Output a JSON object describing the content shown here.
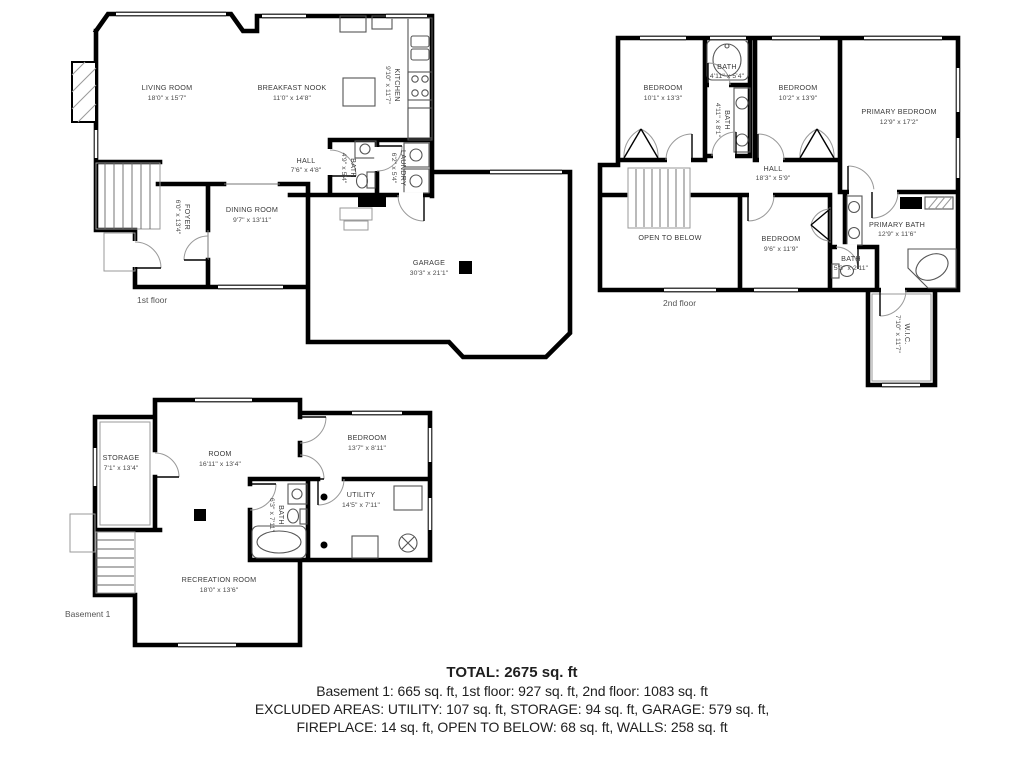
{
  "floors": {
    "first": {
      "label": "1st floor",
      "rooms": {
        "living": {
          "name": "LIVING ROOM",
          "dims": "18'0\" x 15'7\""
        },
        "nook": {
          "name": "BREAKFAST NOOK",
          "dims": "11'0\" x 14'8\""
        },
        "kitchen": {
          "name": "KITCHEN",
          "dims": "9'10\" x 11'7\""
        },
        "hall": {
          "name": "HALL",
          "dims": "7'6\" x 4'8\""
        },
        "bath": {
          "name": "BATH",
          "dims": "4'9\" x 5'4\""
        },
        "laundry": {
          "name": "LAUNDRY",
          "dims": "6'2\" x 5'4\""
        },
        "dining": {
          "name": "DINING ROOM",
          "dims": "9'7\" x 13'11\""
        },
        "foyer": {
          "name": "FOYER",
          "dims": "6'0\" x 13'4\""
        },
        "garage": {
          "name": "GARAGE",
          "dims": "30'3\" x 21'1\""
        }
      }
    },
    "second": {
      "label": "2nd floor",
      "rooms": {
        "bedroom1": {
          "name": "BEDROOM",
          "dims": "10'1\" x 13'3\""
        },
        "bathTop": {
          "name": "BATH",
          "dims": "4'11\" x 5'4\""
        },
        "bedroom2": {
          "name": "BEDROOM",
          "dims": "10'2\" x 13'9\""
        },
        "primaryBedroom": {
          "name": "PRIMARY BEDROOM",
          "dims": "12'9\" x 17'2\""
        },
        "bathMid": {
          "name": "BATH",
          "dims": "4'11\" x 8'1\""
        },
        "hall": {
          "name": "HALL",
          "dims": "18'3\" x 5'9\""
        },
        "openBelow": {
          "name": "OPEN TO BELOW"
        },
        "bedroom3": {
          "name": "BEDROOM",
          "dims": "9'6\" x 11'9\""
        },
        "primaryBath": {
          "name": "PRIMARY BATH",
          "dims": "12'9\" x 11'6\""
        },
        "bathSmall": {
          "name": "BATH",
          "dims": "5'3\" x 2'11\""
        },
        "wic": {
          "name": "W.I.C.",
          "dims": "7'10\" x 11'7\""
        }
      }
    },
    "basement": {
      "label": "Basement 1",
      "rooms": {
        "storage": {
          "name": "STORAGE",
          "dims": "7'1\" x 13'4\""
        },
        "room": {
          "name": "ROOM",
          "dims": "16'11\" x 13'4\""
        },
        "bedroom": {
          "name": "BEDROOM",
          "dims": "13'7\" x 8'11\""
        },
        "bath": {
          "name": "BATH",
          "dims": "6'3\" x 7'11\""
        },
        "utility": {
          "name": "UTILITY",
          "dims": "14'5\" x 7'11\""
        },
        "recreation": {
          "name": "RECREATION ROOM",
          "dims": "18'0\" x 13'6\""
        }
      }
    }
  },
  "summary": {
    "total": "TOTAL: 2675 sq. ft",
    "line1": "Basement 1: 665 sq. ft, 1st floor: 927 sq. ft, 2nd floor: 1083 sq. ft",
    "line2": "EXCLUDED AREAS: UTILITY: 107 sq. ft, STORAGE: 94 sq. ft, GARAGE: 579 sq. ft,",
    "line3": "FIREPLACE: 14 sq. ft, OPEN TO BELOW: 68 sq. ft, WALLS: 258 sq. ft"
  },
  "colors": {
    "wall": "#000000",
    "label": "#3a3a3a",
    "accent": "#000000"
  }
}
